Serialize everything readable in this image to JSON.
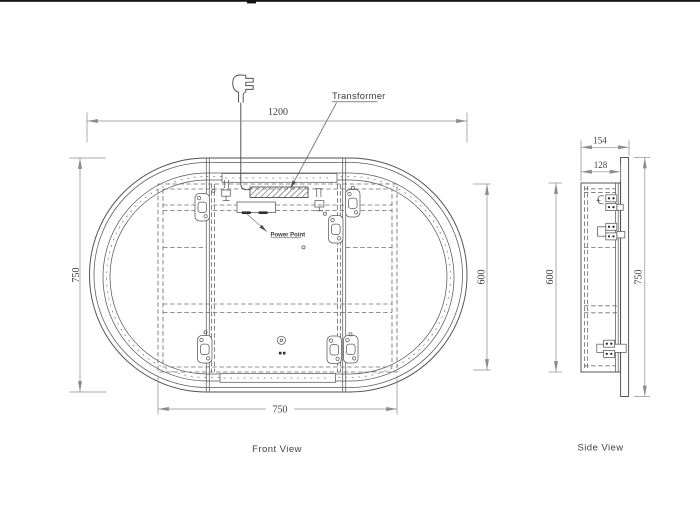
{
  "drawing": {
    "front_view": {
      "label": "Front View",
      "dim_width": "1200",
      "dim_height": "750",
      "dim_cabinet_height": "600",
      "dim_cabinet_width": "750",
      "transformer_label": "Transformer",
      "power_point_label": "Power Point"
    },
    "side_view": {
      "label": "Side View",
      "dim_overall_depth": "154",
      "dim_cabinet_depth": "128",
      "dim_cabinet_height": "600",
      "dim_height": "750"
    },
    "colors": {
      "line": "#4f4f4f",
      "hidden_line": "#6f6f6f",
      "dimension_line": "#8c8c8c",
      "text": "#3d3d3d",
      "background": "#ffffff"
    }
  }
}
